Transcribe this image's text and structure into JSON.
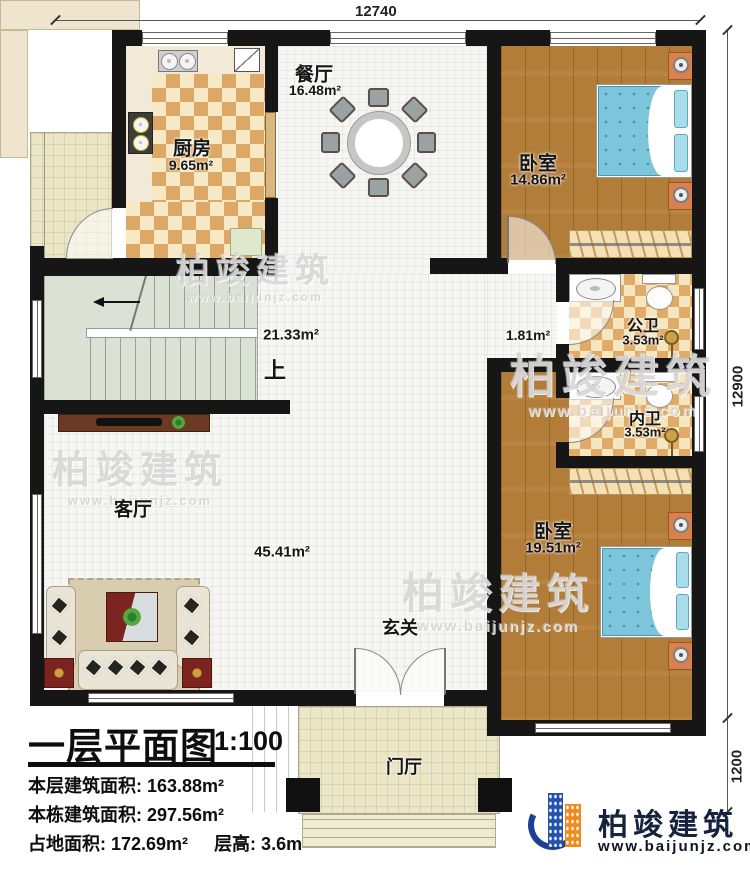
{
  "dimensions": {
    "top": "12740",
    "right": "12900",
    "right_lower": "1200"
  },
  "rooms": {
    "kitchen": {
      "name": "厨房",
      "area": "9.65m²"
    },
    "dining": {
      "name": "餐厅",
      "area": "16.48m²"
    },
    "bedroom1": {
      "name": "卧室",
      "area": "14.86m²"
    },
    "hallway": {
      "area": "21.33m²",
      "up": "上"
    },
    "corridor": {
      "area": "1.81m²"
    },
    "public_bath": {
      "name": "公卫",
      "area": "3.53m²"
    },
    "private_bath": {
      "name": "内卫",
      "area": "3.53m²"
    },
    "bedroom2": {
      "name": "卧室",
      "area": "19.51m²"
    },
    "living": {
      "name": "客厅",
      "area": "45.41m²"
    },
    "entry": {
      "name": "玄关"
    },
    "foyer": {
      "name": "门厅"
    }
  },
  "title_block": {
    "title": "一层平面图",
    "scale": "1:100",
    "stats": [
      "本层建筑面积: 163.88m²",
      "本栋建筑面积: 297.56m²",
      "占地面积: 172.69m²",
      "层高: 3.6m"
    ]
  },
  "branding": {
    "name": "柏竣建筑",
    "website": "www.baijunjz.com"
  },
  "watermark": {
    "text": "柏竣建筑",
    "sub": "www.baijunjz.com"
  }
}
